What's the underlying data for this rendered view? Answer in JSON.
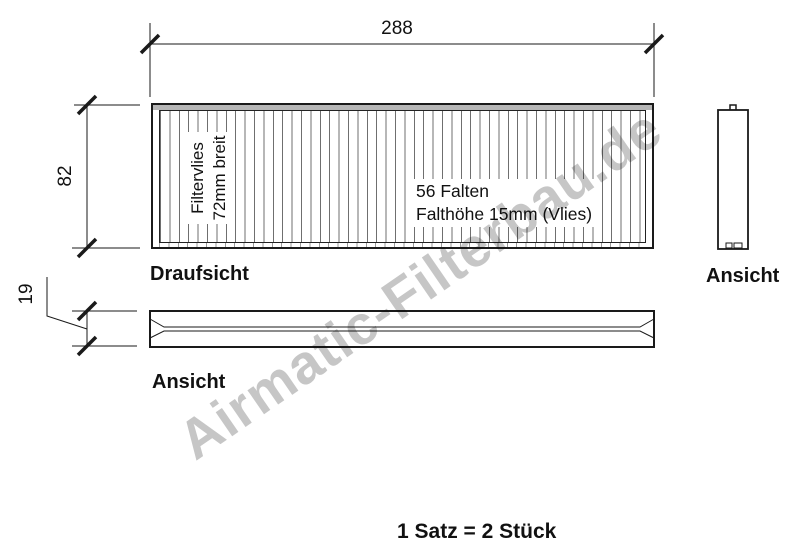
{
  "drawing": {
    "dim_width": "288",
    "dim_height": "82",
    "dim_thickness": "19",
    "top_view": {
      "label": "Draufsicht",
      "media_note": [
        "Filtervlies",
        "72mm breit"
      ],
      "pleat_note": [
        "56 Falten",
        "Falthöhe 15mm (Vlies)"
      ]
    },
    "side_view": {
      "label": "Ansicht"
    },
    "end_view": {
      "label": "Ansicht"
    },
    "quantity_note": "1 Satz = 2 Stück",
    "watermark": "Airmatic-Filterbau.de",
    "colors": {
      "line": "#1a1a1a",
      "pleat_line": "#6f6f6f",
      "frame_band": "#b6b6b6",
      "watermark": "#c6c6c6"
    }
  }
}
